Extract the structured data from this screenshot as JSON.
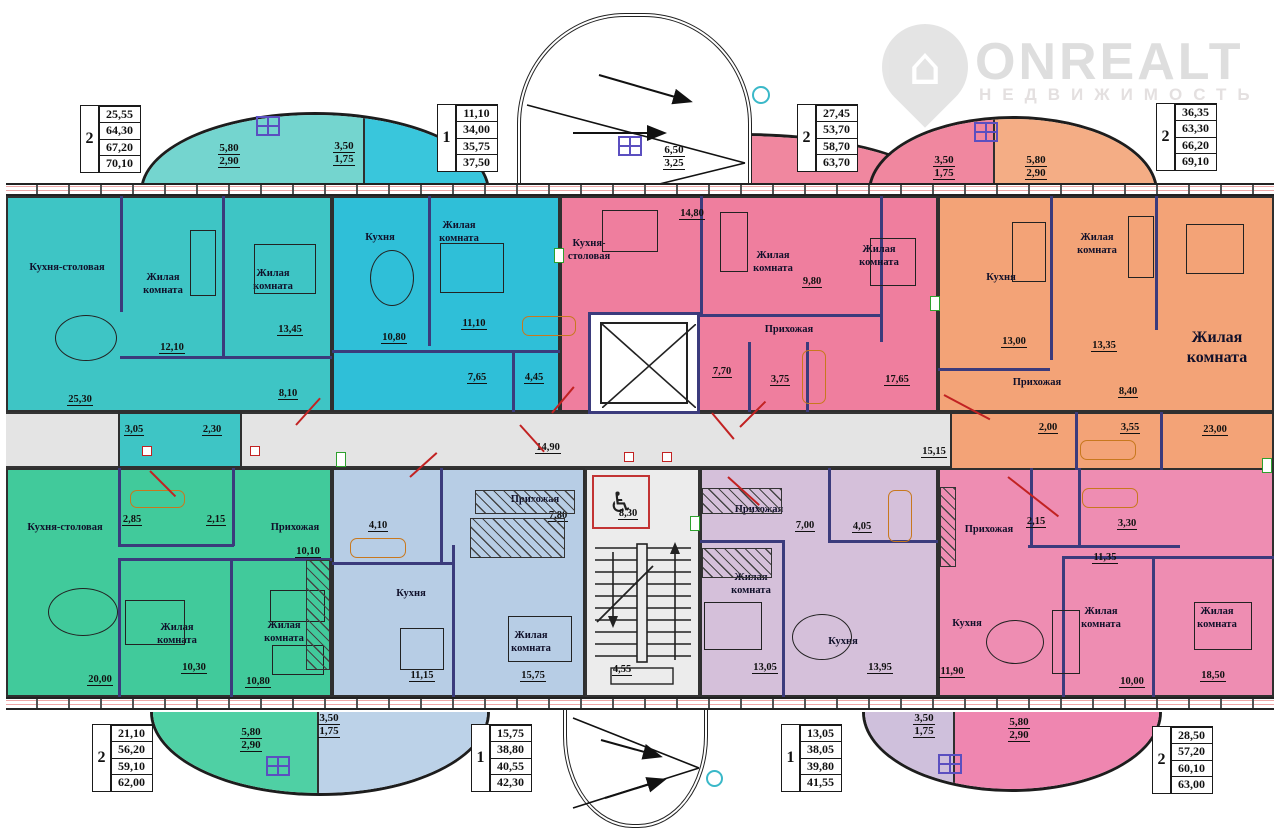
{
  "logo": {
    "brand": "ONREALT",
    "tagline": "НЕДВИЖИМОСТЬ",
    "house_glyph": "⌂"
  },
  "colors": {
    "teal": "#3ec5c5",
    "cyan": "#2fbfd8",
    "pink_top": "#ef7e9e",
    "orange": "#f3a377",
    "green": "#41ca9b",
    "blue": "#b7cde5",
    "lilac": "#d5c0da",
    "pink_bottom": "#ee8db2",
    "balcony_teal": "#74d5cf",
    "balcony_cyan": "#39c6dc",
    "balcony_pink": "#f0879f",
    "balcony_orange": "#f4ad85",
    "balcony_green": "#4fd0a4",
    "balcony_blue": "#bcd2e8",
    "balcony_lilac": "#cfc0dc",
    "balcony_pink2": "#ef86b0",
    "corridor": "#e4e4e4",
    "wall": "#3b3b7c",
    "accent_red": "#c22222"
  },
  "tables": [
    {
      "pos": "top-left",
      "rooms": "2",
      "values": [
        "25,55",
        "64,30",
        "67,20",
        "70,10"
      ]
    },
    {
      "pos": "top-center-left",
      "rooms": "1",
      "values": [
        "11,10",
        "34,00",
        "35,75",
        "37,50"
      ]
    },
    {
      "pos": "top-center-right",
      "rooms": "2",
      "values": [
        "27,45",
        "53,70",
        "58,70",
        "63,70"
      ]
    },
    {
      "pos": "top-right",
      "rooms": "2",
      "values": [
        "36,35",
        "63,30",
        "66,20",
        "69,10"
      ]
    },
    {
      "pos": "bottom-left",
      "rooms": "2",
      "values": [
        "21,10",
        "56,20",
        "59,10",
        "62,00"
      ]
    },
    {
      "pos": "bottom-center-left",
      "rooms": "1",
      "values": [
        "15,75",
        "38,80",
        "40,55",
        "42,30"
      ]
    },
    {
      "pos": "bottom-center-right",
      "rooms": "1",
      "values": [
        "13,05",
        "38,05",
        "39,80",
        "41,55"
      ]
    },
    {
      "pos": "bottom-right",
      "rooms": "2",
      "values": [
        "28,50",
        "57,20",
        "60,10",
        "63,00"
      ]
    }
  ],
  "balconies": {
    "tl_main": {
      "l1": "5,80",
      "l2": "2,90"
    },
    "tl_side": {
      "l1": "3,50",
      "l2": "1,75"
    },
    "tc": {
      "l1": "6,50",
      "l2": "3,25"
    },
    "tr_side": {
      "l1": "3,50",
      "l2": "1,75"
    },
    "tr_main": {
      "l1": "5,80",
      "l2": "2,90"
    },
    "bl_main": {
      "l1": "5,80",
      "l2": "2,90"
    },
    "bl_side": {
      "l1": "3,50",
      "l2": "1,75"
    },
    "br_side": {
      "l1": "3,50",
      "l2": "1,75"
    },
    "br_main": {
      "l1": "5,80",
      "l2": "2,90"
    }
  },
  "corridor": {
    "left": "14,90",
    "right": "15,15"
  },
  "stairwell": {
    "upper": "8,30",
    "lower": "4,55",
    "wheelchair": "♿"
  },
  "apartments": {
    "top_left": {
      "kitchen": "Кухня-столовая",
      "kitchen_area": "25,30",
      "room1": "Жилая комната",
      "room1_area": "12,10",
      "room2": "Жилая комната",
      "room2_area": "13,45",
      "hall_area": "8,10",
      "bath_area": "3,05",
      "wc_area": "2,30"
    },
    "top_center": {
      "kitchen": "Кухня",
      "kitchen_area": "10,80",
      "room": "Жилая комната",
      "room_area": "11,10",
      "hall_area": "7,65",
      "bath_area": "4,45"
    },
    "top_middle": {
      "kitchen": "Кухня-столовая",
      "kitchen_area": "14,80",
      "room1": "Жилая комната",
      "room1_area": "9,80",
      "room2": "Жилая комната",
      "room2_area": "17,65",
      "hall": "Прихожая",
      "hall_area": "7,70",
      "bath_area": "3,75"
    },
    "top_right": {
      "kitchen": "Кухня",
      "kitchen_area": "13,00",
      "room1": "Жилая комната",
      "room1_area": "13,35",
      "room2": "Жилая комната",
      "room2_area": "23,00",
      "hall": "Прихожая",
      "hall_area": "8,40",
      "wc_area": "2,00",
      "bath_area": "3,55"
    },
    "bottom_left": {
      "kitchen": "Кухня-столовая",
      "kitchen_area": "20,00",
      "room1": "Жилая комната",
      "room1_area": "10,30",
      "room2": "Жилая комната",
      "room2_area": "10,80",
      "hall": "Прихожая",
      "hall_area": "10,10",
      "bath_area": "2,85",
      "wc_area": "2,15"
    },
    "bottom_center_left": {
      "hall": "Прихожая",
      "hall_area": "7,80",
      "kitchen": "Кухня",
      "kitchen_area": "11,15",
      "room": "Жилая комната",
      "room_area": "15,75",
      "bath_area": "4,10"
    },
    "bottom_center_right": {
      "hall": "Прихожая",
      "hall_area": "7,00",
      "bath_area": "4,05",
      "room": "Жилая комната",
      "room_area": "13,05",
      "kitchen": "Кухня",
      "kitchen_area": "13,95"
    },
    "bottom_right": {
      "hall": "Прихожая",
      "hall_area": "11,35",
      "wc_area": "2,15",
      "bath_area": "3,30",
      "kitchen": "Кухня",
      "kitchen_area": "11,90",
      "room1": "Жилая комната",
      "room1_area": "10,00",
      "room2": "Жилая комната",
      "room2_area": "18,50"
    }
  }
}
